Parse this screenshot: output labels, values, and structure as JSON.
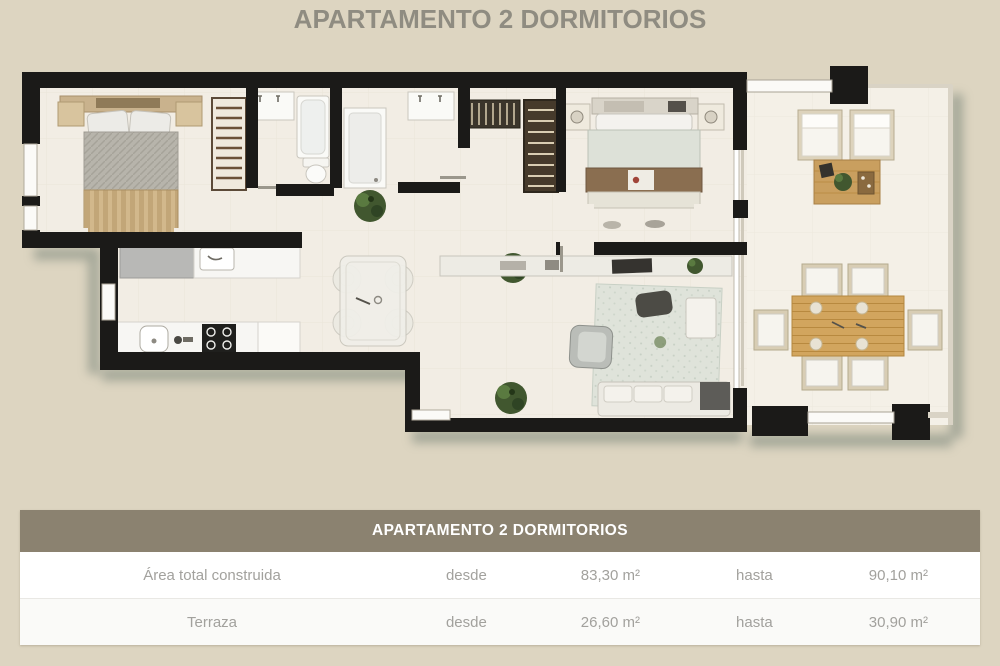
{
  "page_title": "APARTAMENTO 2 DORMITORIOS",
  "table": {
    "header": "APARTAMENTO 2 DORMITORIOS",
    "rows": [
      {
        "label": "Área total construida",
        "from_word": "desde",
        "from_value": "83,30 m²",
        "to_word": "hasta",
        "to_value": "90,10 m²"
      },
      {
        "label": "Terraza",
        "from_word": "desde",
        "from_value": "26,60 m²",
        "to_word": "hasta",
        "to_value": "30,90 m²"
      }
    ]
  },
  "colors": {
    "background": "#ddd5c1",
    "floor": "#f2ede4",
    "terrace_floor": "#f4f0e7",
    "walls": "#1b1a18",
    "table_header_bg": "#8b8270",
    "table_text": "#a2a19d",
    "title_text": "#8f8c81",
    "shadow": "#6d7a71",
    "plant_green": "#41572f",
    "wood": "#cda45f"
  }
}
